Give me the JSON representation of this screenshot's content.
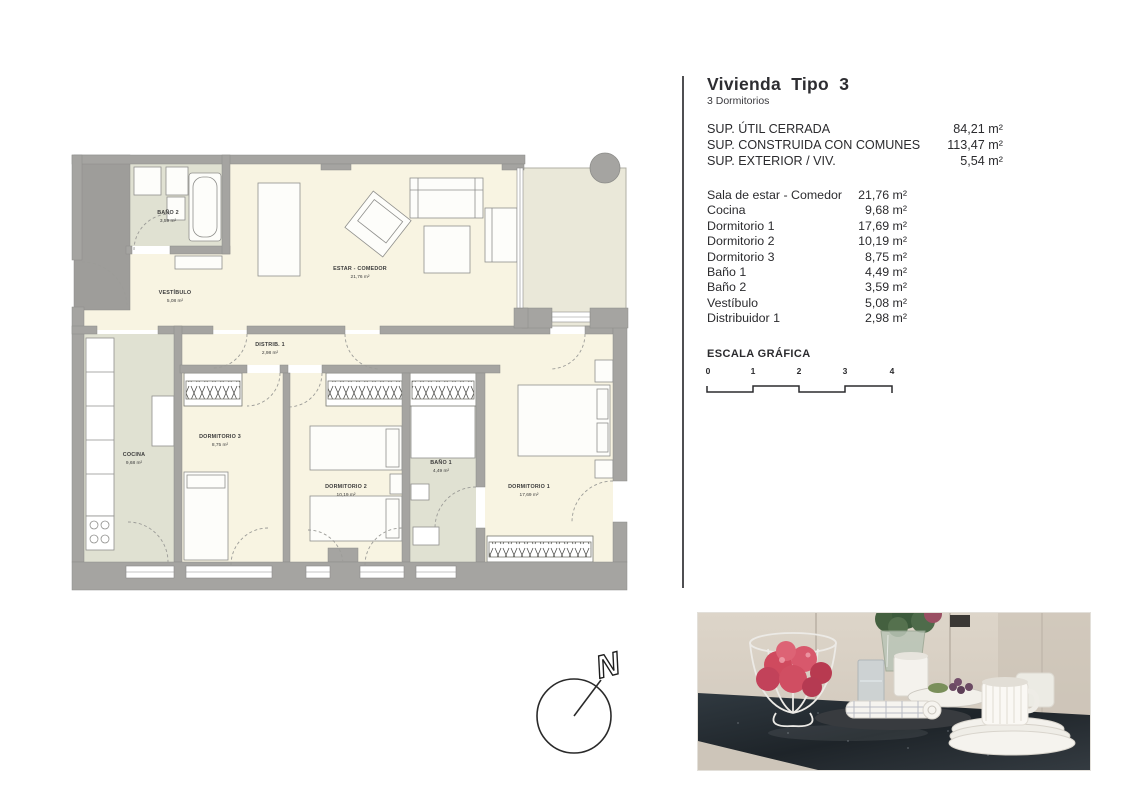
{
  "header": {
    "title": "Vivienda Tipo 3",
    "subtitle": "3 Dormitorios"
  },
  "surfaces": [
    {
      "label": "SUP. ÚTIL CERRADA",
      "value": "84,21 m²"
    },
    {
      "label": "SUP. CONSTRUIDA CON COMUNES",
      "value": "113,47 m²"
    },
    {
      "label": "SUP. EXTERIOR / VIV.",
      "value": "5,54 m²"
    }
  ],
  "rooms": [
    {
      "label": "Sala de estar - Comedor",
      "value": "21,76 m²"
    },
    {
      "label": "Cocina",
      "value": "9,68 m²"
    },
    {
      "label": "Dormitorio 1",
      "value": "17,69 m²"
    },
    {
      "label": "Dormitorio 2",
      "value": "10,19 m²"
    },
    {
      "label": "Dormitorio 3",
      "value": "8,75 m²"
    },
    {
      "label": "Baño 1",
      "value": "4,49 m²"
    },
    {
      "label": "Baño 2",
      "value": "3,59 m²"
    },
    {
      "label": "Vestíbulo",
      "value": "5,08 m²"
    },
    {
      "label": "Distribuidor 1",
      "value": "2,98 m²"
    }
  ],
  "scale": {
    "label": "ESCALA GRÁFICA",
    "ticks": [
      "0",
      "1",
      "2",
      "3",
      "4"
    ]
  },
  "compass": {
    "label": "N"
  },
  "plan": {
    "labels": [
      {
        "name": "BAÑO 2",
        "area": "3,59 m²"
      },
      {
        "name": "VESTÍBULO",
        "area": "5,08 m²"
      },
      {
        "name": "ESTAR - COMEDOR",
        "area": "21,76 m²"
      },
      {
        "name": "DISTRIB. 1",
        "area": "2,98 m²"
      },
      {
        "name": "COCINA",
        "area": "9,68 m²"
      },
      {
        "name": "DORMITORIO 3",
        "area": "8,75 m²"
      },
      {
        "name": "DORMITORIO 2",
        "area": "10,19 m²"
      },
      {
        "name": "BAÑO 1",
        "area": "4,49 m²"
      },
      {
        "name": "DORMITORIO 1",
        "area": "17,69 m²"
      }
    ],
    "colors": {
      "wall": "#a5a4a1",
      "floor": "#f8f4e2",
      "wet_floor": "#e0e1d2",
      "terrace": "#eae8d9"
    }
  }
}
